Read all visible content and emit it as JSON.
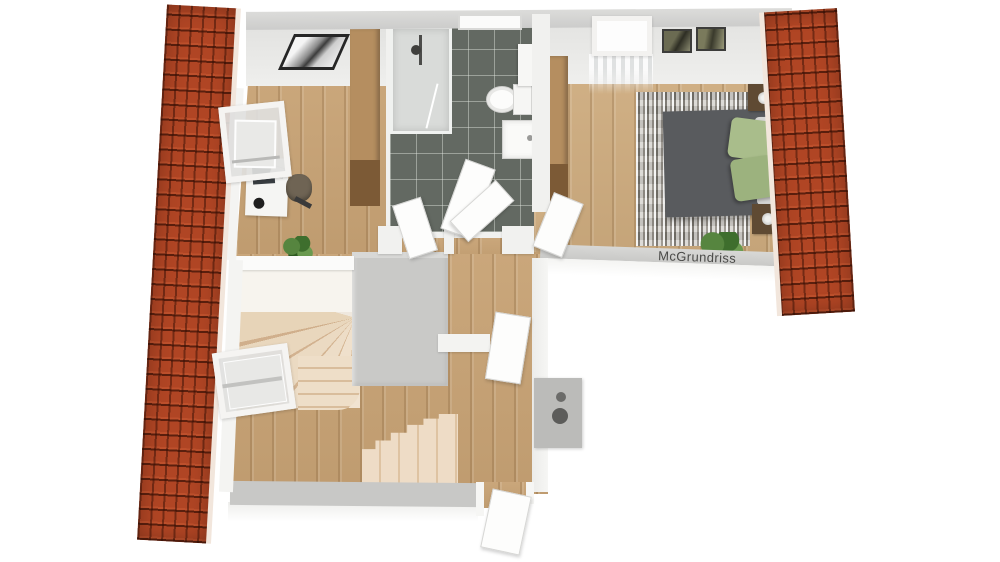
{
  "title": "3D attic floor plan",
  "watermark": {
    "text": "McGrundriss"
  },
  "colors": {
    "background": "#ffffff",
    "roof_tile": "#b04524",
    "roof_tile_gap": "#6e2a12",
    "roof_edge": "#f2e6dc",
    "wall": "#f1f1ef",
    "wall_top_band": "#d3d3d1",
    "wood_floor": "#c7a274",
    "bathroom_tile": "#636962",
    "tile_grout": "#9aa096",
    "stair_tread": "#eedcc6",
    "stair_edge": "#d8bb99",
    "core_wall": "#c9c9c7",
    "bed": "#595b5e",
    "pillow_green": "#a9bd8b",
    "rug": "#b3afa7",
    "wardrobe_light": "#b58e60",
    "wardrobe_dark": "#7c5a36",
    "chimney": "#bbbbb9",
    "plant_green": "#4c7a3a",
    "watermark_text": "#4a4a48"
  },
  "rooms": [
    {
      "id": "office",
      "objects": [
        "open-roof-window",
        "desk",
        "monitor",
        "desk-lamp",
        "office-chair",
        "wardrobe",
        "framed-picture",
        "plant"
      ]
    },
    {
      "id": "bathroom",
      "objects": [
        "shower",
        "toilet",
        "washbasin",
        "wall-cabinet",
        "skylight",
        "open-door"
      ]
    },
    {
      "id": "bedroom",
      "objects": [
        "double-bed",
        "green-pillow-1",
        "green-pillow-2",
        "white-pillows",
        "rug",
        "nightstand-top",
        "nightstand-bottom",
        "table-lamps",
        "wardrobe",
        "roof-window-with-curtains",
        "framed-picture-1",
        "framed-picture-2",
        "plant",
        "open-door"
      ]
    },
    {
      "id": "hallway-landing",
      "objects": [
        "winder-staircase",
        "connector-steps",
        "straight-staircase",
        "open-roof-window",
        "chimney-two-flues",
        "open-door-corridor",
        "open-door-bottom"
      ]
    }
  ],
  "roofs": [
    {
      "side": "left"
    },
    {
      "side": "right"
    }
  ]
}
